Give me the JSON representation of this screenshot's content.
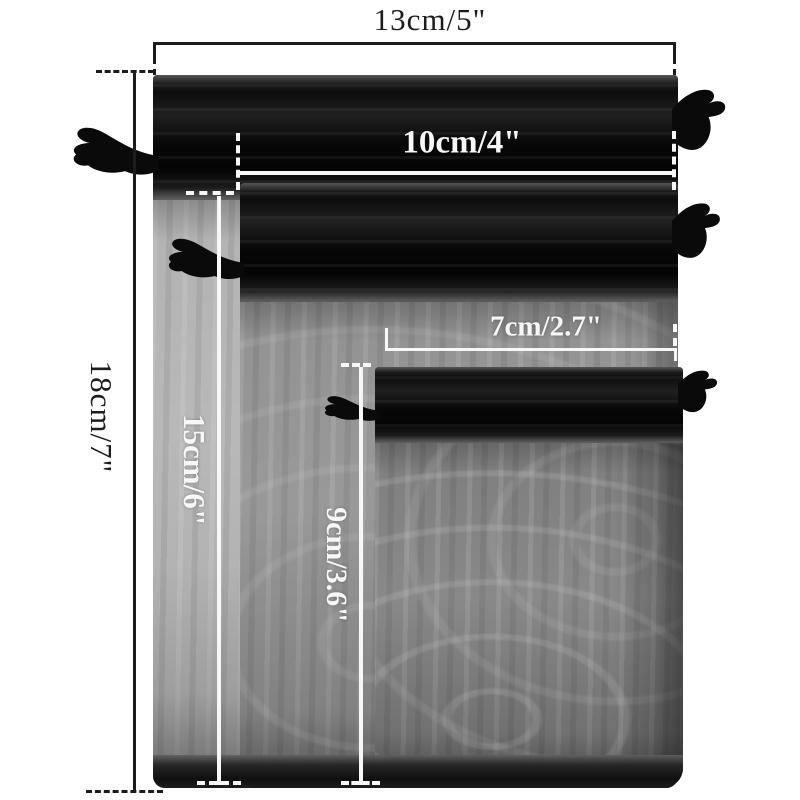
{
  "scene": {
    "description": "Size comparison photo of three black organza drawstring gift bags with dimension lines"
  },
  "items": [
    {
      "name": "large organza drawstring bag",
      "width": "13cm/5\"",
      "height": "18cm/7\""
    },
    {
      "name": "medium organza drawstring bag",
      "width": "10cm/4\"",
      "height": "15cm/6\""
    },
    {
      "name": "small organza drawstring bag",
      "width": "7cm/2.7\"",
      "height": "9cm/3.6\""
    }
  ],
  "colors": {
    "background": "#ffffff",
    "annotation-dark": "#1c1c1c",
    "annotation-light": "#f7f7f7",
    "fabric-black": "#0d0d0d",
    "body-large": "#b3b3b3",
    "body-medium": "#939393",
    "body-small": "#808080"
  }
}
